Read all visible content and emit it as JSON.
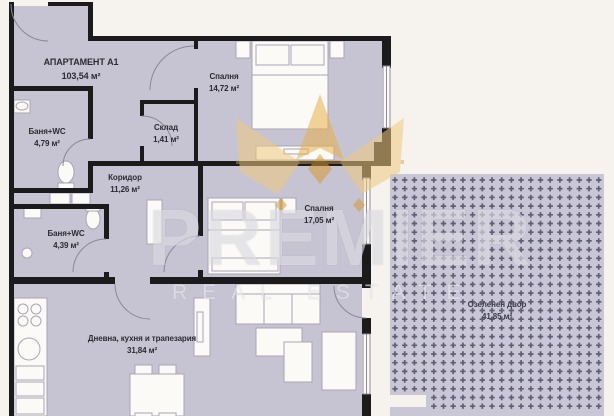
{
  "apartment": {
    "name": "АПАРТАМЕНТ А1",
    "area": "103,54 м²"
  },
  "rooms": [
    {
      "name": "Баня+WC",
      "area": "4,79 м²"
    },
    {
      "name": "Склад",
      "area": "1,41 м²"
    },
    {
      "name": "Коридор",
      "area": "11,26 м²"
    },
    {
      "name": "Спалня",
      "area": "14,72 м²"
    },
    {
      "name": "Баня+WC",
      "area": "4,39 м²"
    },
    {
      "name": "Спалня",
      "area": "17,05 м²"
    },
    {
      "name": "Дневна, кухня и трапезария",
      "area": "31,84 м²"
    },
    {
      "name": "Озеленен двор",
      "area": "41,85 м²"
    }
  ],
  "watermark": {
    "brand": "PREMIER",
    "tagline": "REAL ESTATE",
    "icon": "crown-icon"
  },
  "colors": {
    "background": "#f6f3ee",
    "floor": "#c6c4d3",
    "wall": "#1b1b1b",
    "yard_fill": "#c9c7d6",
    "yard_hatch": "#5e5e74",
    "furniture_fill": "#fbfaf7",
    "furniture_stroke": "#a8a6b5",
    "crown_gold": "#e0a33e"
  }
}
